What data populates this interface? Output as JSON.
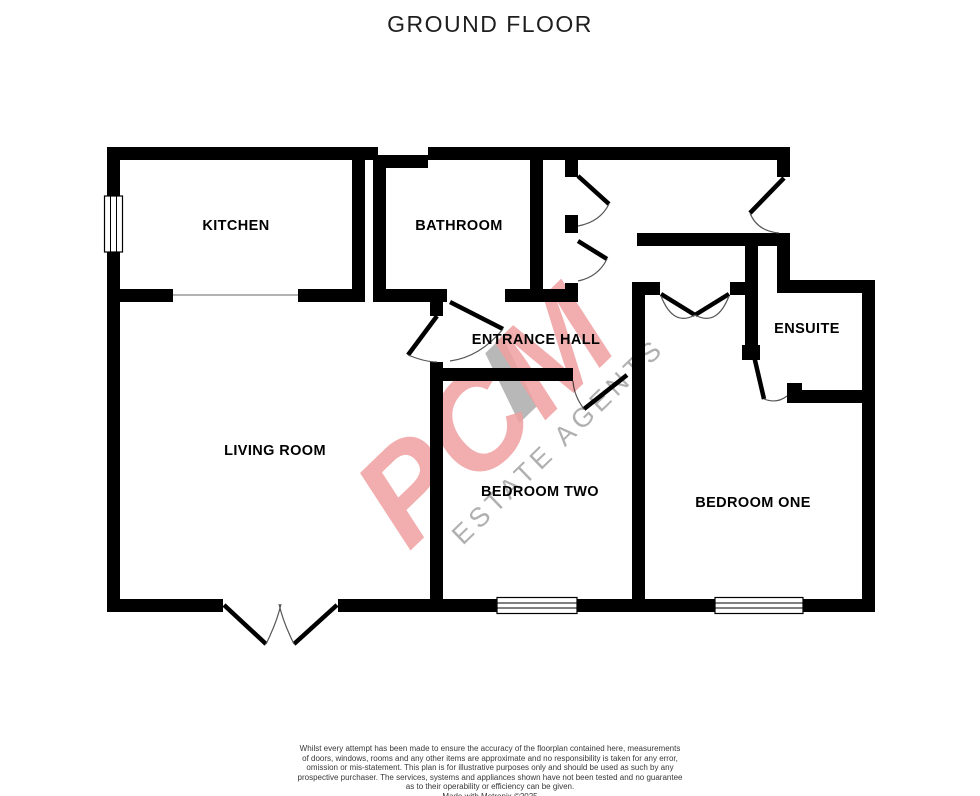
{
  "title": "GROUND FLOOR",
  "rooms": {
    "kitchen": {
      "label": "KITCHEN"
    },
    "bathroom": {
      "label": "BATHROOM"
    },
    "entrance_hall": {
      "label": "ENTRANCE HALL"
    },
    "living_room": {
      "label": "LIVING ROOM"
    },
    "bedroom_two": {
      "label": "BEDROOM TWO"
    },
    "bedroom_one": {
      "label": "BEDROOM ONE"
    },
    "ensuite": {
      "label": "ENSUITE"
    }
  },
  "watermark": {
    "brand": "PCM",
    "tagline": "ESTATE AGENTS",
    "brand_color": "#f09fa0",
    "tagline_color": "#a3a3a3"
  },
  "disclaimer": {
    "lines": [
      "Whilst every attempt has been made to ensure the accuracy of the floorplan contained here, measurements",
      "of doors, windows, rooms and any other items are approximate and no responsibility is taken for any error,",
      "omission or mis-statement. This plan is for illustrative purposes only and should be used as such by any",
      "prospective purchaser. The services, systems and appliances shown have not been tested and no guarantee",
      "as to their operability or efficiency can be given."
    ],
    "credit": "Made with Metropix ©2025"
  },
  "colors": {
    "wall": "#000000",
    "background": "#ffffff",
    "door_arc": "#555555",
    "open_divider": "#999999"
  }
}
